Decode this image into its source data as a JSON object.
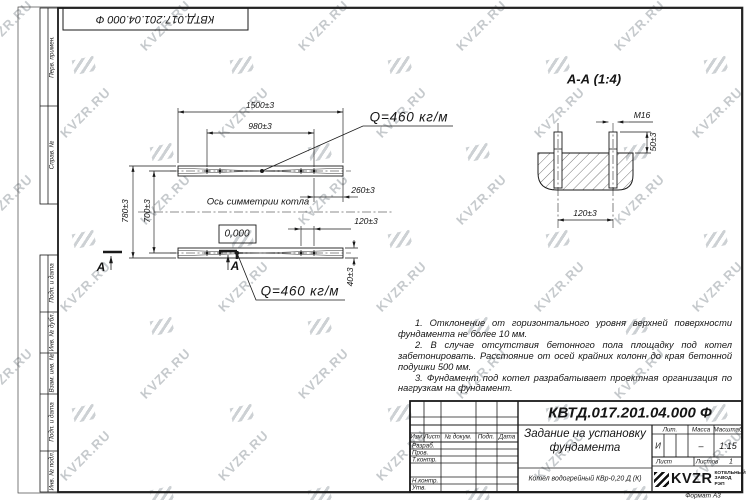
{
  "sheet": {
    "watermark_text": "KVZR.RU",
    "format_label": "Формат А3",
    "doc_number": "КВТД.017.201.04.000 Ф"
  },
  "margin_column": {
    "labels": [
      "Перв. примен.",
      "Справ. №",
      "Подп. и дата",
      "Инв. № дубл.",
      "Взам. инв. №",
      "Подп. и дата",
      "Инв. № подл."
    ]
  },
  "plan": {
    "dim_length_outer": "1500±3",
    "dim_length_inner": "980±3",
    "dim_width_outer": "780±3",
    "dim_width_inner": "700±3",
    "dim_end_offset": "260±3",
    "dim_bolt_pair": "120±3",
    "dim_channel_height": "40±3",
    "axis_label": "Ось симметрии котла",
    "level_mark": "0,000",
    "load_label_top": "Q=460 кг/м",
    "load_label_bottom": "Q=460 кг/м",
    "section_letter_left": "А",
    "section_letter_right": "А"
  },
  "section_view": {
    "title": "А-А (1:4)",
    "bolt_thread": "М16",
    "dim_protrusion": "50±3",
    "dim_spacing": "120±3"
  },
  "notes": {
    "items": [
      "1. Отклонение от горизонтального уровня верхней поверхности фундамента не более 10 мм.",
      "2. В случае отсутствия бетонного пола площадку под котел забетонировать. Расстояние от осей крайних колонн до края бетонной подушки 500 мм.",
      "3. Фундамент под котел разрабатывает проектная организация по нагрузкам на фундамент."
    ]
  },
  "title_block": {
    "doc_number": "КВТД.017.201.04.000 Ф",
    "title": "Задание на установку фундамента",
    "product": "Котел водогрейный КВр-0,20 Д (К)",
    "header_cols": {
      "izm": "Изм.",
      "list": "Лист",
      "doc": "№ докум.",
      "podp": "Подп.",
      "data": "Дата"
    },
    "rows": {
      "razrab": "Разраб.",
      "prov": "Пров.",
      "tkontr": "Т.контр.",
      "nkontr": "Н.контр.",
      "utv": "Утв."
    },
    "lit_label": "Лит.",
    "lit_value": "И",
    "mass_label": "Масса",
    "mass_value": "–",
    "scale_label": "Масштаб",
    "scale_value": "1:15",
    "sheet_label": "Лист",
    "sheets_label": "Листов",
    "sheets_value": "1",
    "logo_text": "KVZR",
    "logo_subtext": "КОТЕЛЬНЫЙ ЗАВОД РЭП"
  }
}
